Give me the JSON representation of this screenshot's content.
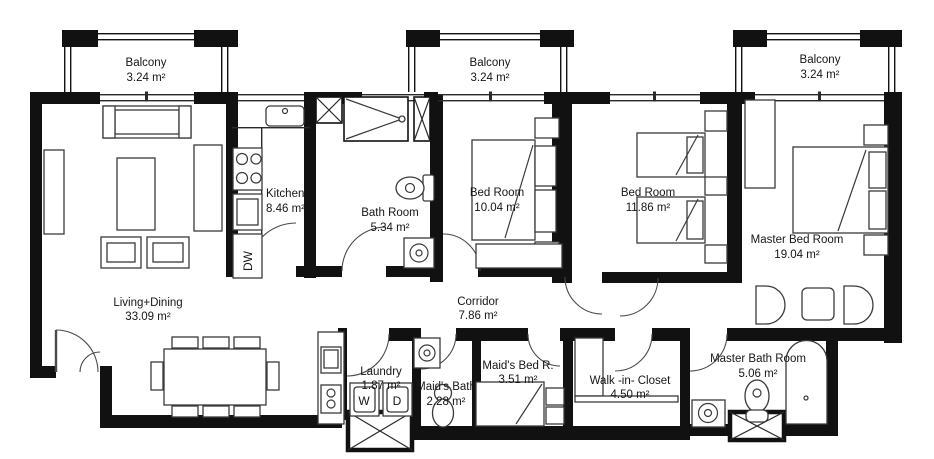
{
  "title": "Apartment Floor Plan",
  "rooms": [
    {
      "id": "balcony-left",
      "name": "Balcony",
      "area": "3.24 m²"
    },
    {
      "id": "balcony-middle",
      "name": "Balcony",
      "area": "3.24 m²"
    },
    {
      "id": "balcony-right",
      "name": "Balcony",
      "area": "3.24 m²"
    },
    {
      "id": "kitchen",
      "name": "Kitchen",
      "area": "8.46 m²"
    },
    {
      "id": "bathroom",
      "name": "Bath Room",
      "area": "5.34 m²"
    },
    {
      "id": "bedroom-1",
      "name": "Bed Room",
      "area": "10.04 m²"
    },
    {
      "id": "bedroom-2",
      "name": "Bed Room",
      "area": "11.86 m²"
    },
    {
      "id": "master-bedroom",
      "name": "Master Bed Room",
      "area": "19.04 m²"
    },
    {
      "id": "living-dining",
      "name": "Living+Dining",
      "area": "33.09 m²"
    },
    {
      "id": "corridor",
      "name": "Corridor",
      "area": "7.86 m²"
    },
    {
      "id": "laundry",
      "name": "Laundry",
      "area": "1.87 m²"
    },
    {
      "id": "maids-bath",
      "name": "Maid's Bath",
      "area": "2.28 m²"
    },
    {
      "id": "maids-bedroom",
      "name": "Maid's Bed R.",
      "area": "3.51 m²"
    },
    {
      "id": "walk-in-closet",
      "name": "Walk -in- Closet",
      "area": "4.50 m²"
    },
    {
      "id": "master-bathroom",
      "name": "Master Bath Room",
      "area": "5.06 m²"
    }
  ],
  "appliances": {
    "washer": "W",
    "dryer": "D",
    "dishwasher": "DW"
  },
  "colors": {
    "wall": "#111111",
    "furniture": "#3a3a3a",
    "text": "#161616",
    "background": "#ffffff"
  }
}
